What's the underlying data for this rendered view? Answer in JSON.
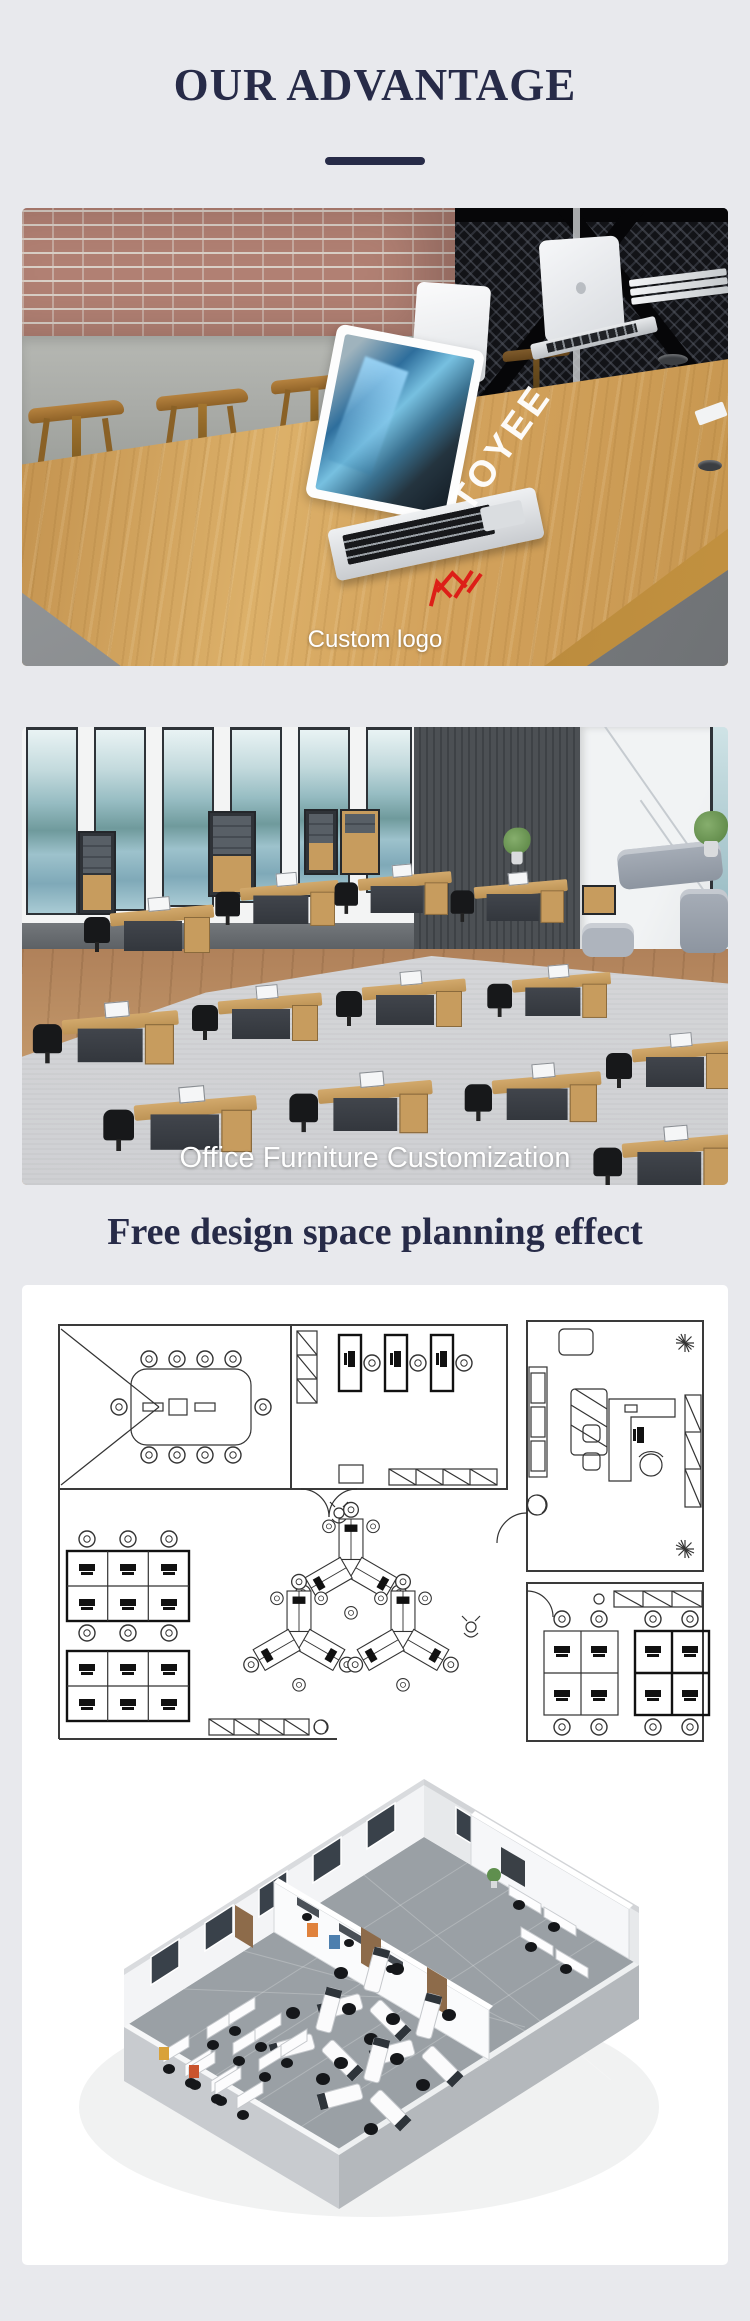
{
  "page": {
    "background_color": "#e8e9ed",
    "accent_color": "#272b48",
    "caption_color": "#ffffff",
    "logo_red": "#dd1f18"
  },
  "header": {
    "title": "OUR ADVANTAGE"
  },
  "advantages": {
    "custom_logo": {
      "caption": "Custom logo",
      "watermark": "TOYEE",
      "image_alt": "Wooden conference table with laptops, brick wall and engraved brand logo"
    },
    "office_customization": {
      "caption": "Office Furniture Customization",
      "image_alt": "Open plan office with customized workstations, cabinets and lounge sofas"
    }
  },
  "design_section": {
    "heading": "Free design space planning effect",
    "image_alt": "2D CAD office floor plan and 3D rendered space planning effect"
  }
}
